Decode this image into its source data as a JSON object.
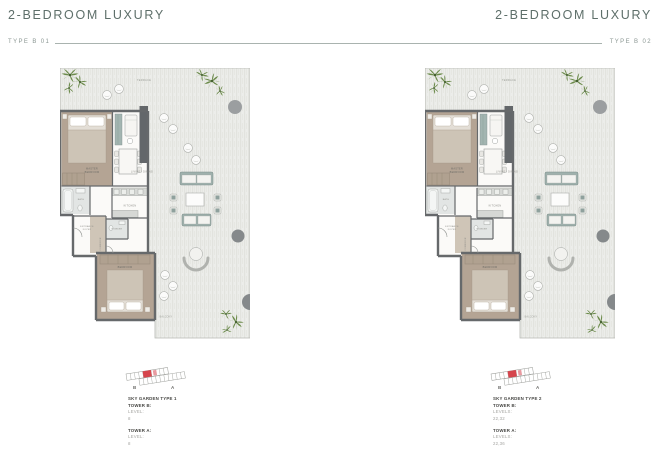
{
  "colors": {
    "accent_teal": "#5e6f6a",
    "rule_gray_teal": "#a9b3af",
    "keyplan_red": "#d6454d",
    "wall_gray": "#66696b",
    "floor_taupe": "#b4a494",
    "deck_light_gray": "#ecedea",
    "plant_green": "#6b8a4a",
    "caption_dark": "#474744",
    "caption_muted": "#a5a5a2"
  },
  "left": {
    "title": "2-BEDROOM LUXURY",
    "type_label": "TYPE B 01",
    "caption": {
      "title": "SKY GARDEN TYPE 1",
      "groups": [
        {
          "tower": "TOWER B:",
          "level_label": "LEVEL:",
          "level_value": "8"
        },
        {
          "tower": "TOWER A:",
          "level_label": "LEVEL:",
          "level_value": "8"
        }
      ]
    }
  },
  "right": {
    "title": "2-BEDROOM LUXURY",
    "type_label": "TYPE B 02",
    "caption": {
      "title": "SKY GARDEN TYPE 2",
      "groups": [
        {
          "tower": "TOWER B:",
          "level_label": "LEVELS:",
          "level_value": "22,32"
        },
        {
          "tower": "TOWER A:",
          "level_label": "LEVELS:",
          "level_value": "22,36"
        }
      ]
    }
  },
  "keyplan": {
    "tower_b_letter": "B",
    "tower_a_letter": "A"
  },
  "plan_labels": {
    "terrace": "TERRACE",
    "master_1": "MASTER",
    "master_2": "BEDROOM",
    "living": "LIVING / DINING",
    "kitchen": "KITCHEN",
    "bedroom2": "BEDROOM",
    "balcony": "BALCONY",
    "entrance_1": "ENTRANCE",
    "entrance_2": "FOYER",
    "powder": "POWDER",
    "bath": "BATH",
    "corridor": "CORRIDOR"
  }
}
